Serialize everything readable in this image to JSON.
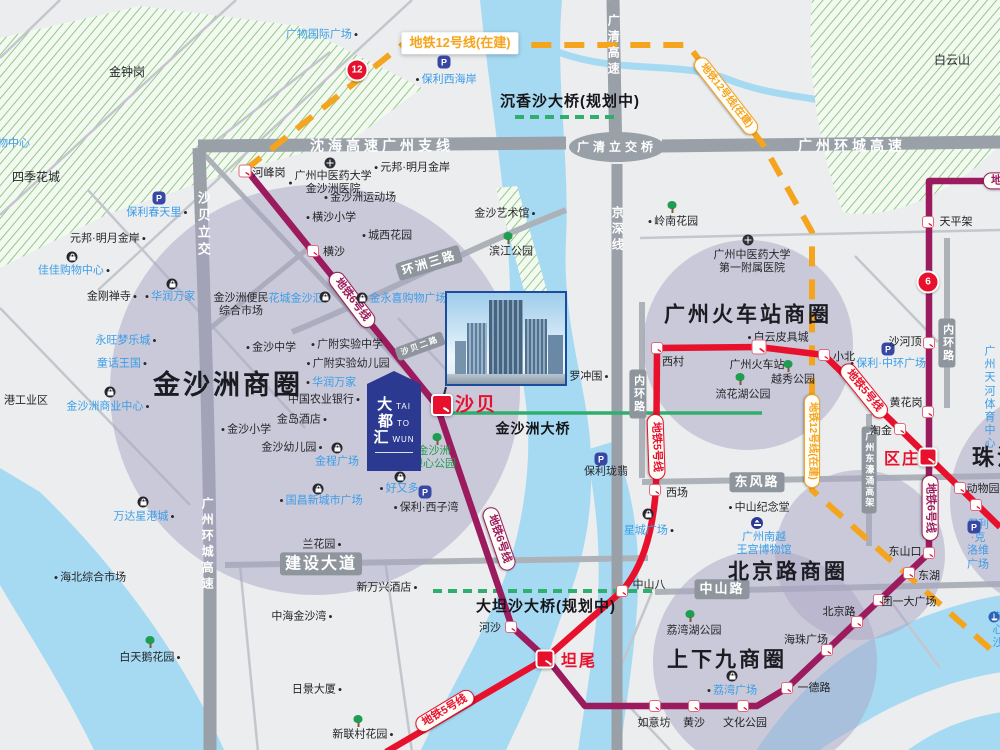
{
  "colors": {
    "line5": "#e8112d",
    "line6": "#9b1b5e",
    "line12": "#f5a41d",
    "water": "#a6daf2",
    "land": "#ebedee",
    "roadMajor": "#9aa0a8",
    "roadMed": "#adb2b9",
    "roadMinor": "#c3c7cd",
    "roadBox": "#8f959d",
    "circleFill": "rgba(170,165,196,0.5)",
    "green": "#2fae6e",
    "hatchLine": "#8fcb86",
    "hatchBg": "#f3f9f1",
    "blueText": "#3b9de8",
    "greenText": "#1f9e4b",
    "redText": "#e60012",
    "polyBlue": "#3847a3",
    "logoBlue": "#2b3990"
  },
  "icons": {
    "dot": "●",
    "p": "P"
  },
  "logo": {
    "rows": [
      {
        "cn": "大",
        "en": "TAI"
      },
      {
        "cn": "都",
        "en": "TO"
      },
      {
        "cn": "汇",
        "en": "WUN"
      }
    ]
  },
  "map": {
    "features": [
      {
        "t": "金钟岗",
        "x": 127,
        "y": 72,
        "k": "k",
        "s": 12
      },
      {
        "t": "四季花城",
        "x": 36,
        "y": 177,
        "k": "k",
        "s": 12
      },
      {
        "t": "购物中心",
        "x": 8,
        "y": 144,
        "k": "b"
      },
      {
        "t": "元邦·明月金岸",
        "x": 108,
        "y": 239,
        "k": "k",
        "dot": "r"
      },
      {
        "t": "佳佳购物中心",
        "x": 74,
        "y": 271,
        "k": "b",
        "dot": "r"
      },
      {
        "t": "金刚禅寺",
        "x": 112,
        "y": 297,
        "k": "k",
        "dot": "r"
      },
      {
        "t": "华润万家",
        "x": 170,
        "y": 297,
        "k": "b",
        "dot": "l"
      },
      {
        "t": "永旺梦乐城",
        "x": 126,
        "y": 341,
        "k": "b",
        "dot": "r"
      },
      {
        "t": "童话王国",
        "x": 122,
        "y": 364,
        "k": "b",
        "dot": "r"
      },
      {
        "t": "金沙洲商业中心",
        "x": 108,
        "y": 407,
        "k": "b",
        "dot": "r"
      },
      {
        "t": "港工业区",
        "x": 26,
        "y": 401,
        "k": "k"
      },
      {
        "t": "万达星港城",
        "x": 144,
        "y": 517,
        "k": "b",
        "dot": "r"
      },
      {
        "t": "海北综合市场",
        "x": 90,
        "y": 578,
        "k": "k",
        "dot": "l"
      },
      {
        "t": "白天鹅花园",
        "x": 150,
        "y": 658,
        "k": "k",
        "dot": "r"
      },
      {
        "t": "保利春天里",
        "x": 157,
        "y": 213,
        "k": "b",
        "dot": "r"
      },
      {
        "t": "元邦·明月金岸",
        "x": 412,
        "y": 168,
        "k": "k",
        "dot": "l"
      },
      {
        "t": "保利西海岸",
        "x": 446,
        "y": 80,
        "k": "b",
        "dot": "l"
      },
      {
        "t": "广物国际广场",
        "x": 322,
        "y": 35,
        "k": "b",
        "dot": "r"
      },
      {
        "t": "沙贝二路",
        "x": 420,
        "y": 346,
        "k": "roadbox",
        "s": 8,
        "rot": -20
      },
      {
        "t": "环洲三路",
        "x": 429,
        "y": 263,
        "k": "roadbox",
        "s": 12,
        "rot": -17
      },
      {
        "t": "金沙洲便民\n综合市场",
        "x": 241,
        "y": 305,
        "k": "k"
      },
      {
        "t": "花城金沙汇",
        "x": 296,
        "y": 299,
        "k": "b"
      },
      {
        "t": "金永喜购物广场",
        "x": 408,
        "y": 299,
        "k": "b"
      },
      {
        "t": "横沙小学",
        "x": 331,
        "y": 218,
        "k": "k",
        "dot": "l"
      },
      {
        "t": "城西花园",
        "x": 387,
        "y": 236,
        "k": "k",
        "dot": "l"
      },
      {
        "t": "金沙洲运动场",
        "x": 360,
        "y": 198,
        "k": "k",
        "dot": "l"
      },
      {
        "t": "广州中医药大学\n金沙洲医院",
        "x": 330,
        "y": 183,
        "k": "k",
        "dot": "l"
      },
      {
        "t": "金沙中学",
        "x": 271,
        "y": 348,
        "k": "k",
        "dot": "l"
      },
      {
        "t": "广附实验中学",
        "x": 347,
        "y": 345,
        "k": "k",
        "dot": "l"
      },
      {
        "t": "广附实验幼儿园",
        "x": 348,
        "y": 364,
        "k": "k",
        "dot": "l"
      },
      {
        "t": "华润万家",
        "x": 331,
        "y": 383,
        "k": "b",
        "dot": "l"
      },
      {
        "t": "中国农业银行",
        "x": 324,
        "y": 400,
        "k": "k",
        "dot": "r"
      },
      {
        "t": "金岛酒店",
        "x": 302,
        "y": 420,
        "k": "k",
        "dot": "r"
      },
      {
        "t": "金沙小学",
        "x": 246,
        "y": 430,
        "k": "k",
        "dot": "l"
      },
      {
        "t": "金沙幼儿园",
        "x": 292,
        "y": 448,
        "k": "k",
        "dot": "r"
      },
      {
        "t": "金程广场",
        "x": 337,
        "y": 462,
        "k": "b"
      },
      {
        "t": "国昌新城市广场",
        "x": 321,
        "y": 501,
        "k": "b",
        "dot": "l"
      },
      {
        "t": "好又多",
        "x": 399,
        "y": 489,
        "k": "b",
        "dot": "l"
      },
      {
        "t": "保利·西子湾",
        "x": 426,
        "y": 508,
        "k": "k",
        "dot": "l"
      },
      {
        "t": "兰花园",
        "x": 322,
        "y": 545,
        "k": "k",
        "dot": "r"
      },
      {
        "t": "建设大道",
        "x": 321,
        "y": 564,
        "k": "roadbox",
        "s": 16
      },
      {
        "t": "新万兴酒店",
        "x": 387,
        "y": 588,
        "k": "k",
        "dot": "r"
      },
      {
        "t": "中海金沙湾",
        "x": 302,
        "y": 617,
        "k": "k",
        "dot": "r"
      },
      {
        "t": "日景大厦",
        "x": 317,
        "y": 690,
        "k": "k",
        "dot": "r"
      },
      {
        "t": "新联村花园",
        "x": 363,
        "y": 735,
        "k": "k",
        "dot": "r"
      },
      {
        "t": "金沙洲商圈",
        "x": 228,
        "y": 385,
        "k": "big",
        "s": 27
      },
      {
        "t": "金沙洲\n绿心公园",
        "x": 434,
        "y": 458,
        "k": "g"
      },
      {
        "t": "沙贝立交",
        "x": 203,
        "y": 225,
        "k": "roadtextv",
        "s": 13
      },
      {
        "t": "广州环城高速",
        "x": 207,
        "y": 545,
        "k": "roadtextv",
        "s": 12
      },
      {
        "t": "沈海高速广州支线",
        "x": 382,
        "y": 146,
        "k": "roadtext",
        "s": 14
      },
      {
        "t": "广清高速",
        "x": 613,
        "y": 46,
        "k": "roadtextv",
        "s": 12
      },
      {
        "t": "广清立交桥",
        "x": 617,
        "y": 147,
        "k": "roadtext",
        "s": 12
      },
      {
        "t": "广州环城高速",
        "x": 852,
        "y": 146,
        "k": "roadtext",
        "s": 14
      },
      {
        "t": "京深线",
        "x": 617,
        "y": 230,
        "k": "roadtextv",
        "s": 12
      },
      {
        "t": "沉香沙大桥(规划中)",
        "x": 570,
        "y": 102,
        "k": "bold",
        "s": 15
      },
      {
        "t": "大坦沙大桥(规划中)",
        "x": 546,
        "y": 607,
        "k": "bold",
        "s": 15
      },
      {
        "t": "金沙洲大桥",
        "x": 533,
        "y": 429,
        "k": "bold",
        "s": 14
      },
      {
        "t": "白云山",
        "x": 952,
        "y": 60,
        "k": "k",
        "s": 12
      },
      {
        "t": "岭南花园",
        "x": 673,
        "y": 222,
        "k": "k",
        "dot": "l"
      },
      {
        "t": "金沙艺术馆",
        "x": 505,
        "y": 214,
        "k": "k",
        "dot": "r"
      },
      {
        "t": "滨江公园",
        "x": 511,
        "y": 252,
        "k": "k"
      },
      {
        "t": "罗冲围",
        "x": 589,
        "y": 377,
        "k": "k",
        "dot": "r"
      },
      {
        "t": "保利珑翡",
        "x": 606,
        "y": 472,
        "k": "k"
      },
      {
        "t": "内环路",
        "x": 638,
        "y": 394,
        "k": "roadboxv",
        "s": 11
      },
      {
        "t": "内环路",
        "x": 947,
        "y": 343,
        "k": "roadboxv",
        "s": 11
      },
      {
        "t": "东风路",
        "x": 757,
        "y": 482,
        "k": "roadbox",
        "s": 13
      },
      {
        "t": "中山路",
        "x": 722,
        "y": 589,
        "k": "roadbox",
        "s": 13
      },
      {
        "t": "广州东濠涌高架",
        "x": 869,
        "y": 470,
        "k": "roadboxv",
        "s": 9
      },
      {
        "t": "广州中医药大学\n第一附属医院",
        "x": 752,
        "y": 262,
        "k": "k"
      },
      {
        "t": "广州火车站商圈",
        "x": 748,
        "y": 315,
        "k": "big",
        "s": 21
      },
      {
        "t": "白云皮具城",
        "x": 778,
        "y": 338,
        "k": "k",
        "dot": "l"
      },
      {
        "t": "越秀公园",
        "x": 793,
        "y": 380,
        "k": "k"
      },
      {
        "t": "流花湖公园",
        "x": 743,
        "y": 395,
        "k": "k"
      },
      {
        "t": "保利·中环广场",
        "x": 888,
        "y": 364,
        "k": "b",
        "dot": "l"
      },
      {
        "t": "广州天河\n体育中心",
        "x": 990,
        "y": 398,
        "k": "b"
      },
      {
        "t": "中山纪念堂",
        "x": 759,
        "y": 508,
        "k": "k",
        "dot": "l"
      },
      {
        "t": "广州南越\n王宫博物馆",
        "x": 764,
        "y": 544,
        "k": "b"
      },
      {
        "t": "北京路商圈",
        "x": 788,
        "y": 572,
        "k": "big",
        "s": 21
      },
      {
        "t": "上下九商圈",
        "x": 727,
        "y": 660,
        "k": "big",
        "s": 21
      },
      {
        "t": "荔湾湖公园",
        "x": 694,
        "y": 631,
        "k": "k"
      },
      {
        "t": "荔湾广场",
        "x": 732,
        "y": 691,
        "k": "b",
        "dot": "l"
      },
      {
        "t": "珠江新城",
        "x": 1022,
        "y": 458,
        "k": "big",
        "s": 22
      },
      {
        "t": "保利·克洛维广场",
        "x": 978,
        "y": 545,
        "k": "b"
      },
      {
        "t": "海心沙",
        "x": 998,
        "y": 631,
        "k": "b"
      },
      {
        "t": "星城广场",
        "x": 649,
        "y": 531,
        "k": "b",
        "dot": "r"
      },
      {
        "t": "地铁12号线(在建)",
        "x": 460,
        "y": 43,
        "k": "lc12box",
        "s": 13
      },
      {
        "t": "地铁12号线(在建)",
        "x": 726,
        "y": 96,
        "k": "lc12",
        "rot": 52,
        "s": 10
      },
      {
        "t": "地铁12号线(在建)",
        "x": 812,
        "y": 441,
        "k": "lc12",
        "rot": 90,
        "s": 10
      },
      {
        "t": "地铁6号线",
        "x": 352,
        "y": 300,
        "k": "lc6",
        "rot": 53
      },
      {
        "t": "地铁6号线",
        "x": 499,
        "y": 539,
        "k": "lc6",
        "rot": 71
      },
      {
        "t": "地铁6号线",
        "x": 930,
        "y": 508,
        "k": "lc6",
        "rot": 90
      },
      {
        "t": "地铁6号线",
        "x": 1016,
        "y": 181,
        "k": "lc6"
      },
      {
        "t": "地铁5号线",
        "x": 656,
        "y": 447,
        "k": "lc5",
        "rot": 88
      },
      {
        "t": "地铁5号线",
        "x": 864,
        "y": 391,
        "k": "lc5",
        "rot": 51
      },
      {
        "t": "地铁5号线",
        "x": 445,
        "y": 711,
        "k": "lc5",
        "rot": -31
      }
    ],
    "stations": [
      {
        "n": "河峰岗",
        "x": 245,
        "y": 171,
        "s": 13,
        "lx": 269,
        "ly": 172
      },
      {
        "n": "横沙",
        "x": 313,
        "y": 251,
        "s": 12,
        "lx": 334,
        "ly": 251
      },
      {
        "n": "沙贝",
        "x": 442,
        "y": 405,
        "s": 22,
        "red": 1,
        "lx": 476,
        "ly": 403,
        "lr": 1,
        "ls": 19
      },
      {
        "n": "河沙",
        "x": 511,
        "y": 627,
        "s": 12,
        "lx": 490,
        "ly": 627
      },
      {
        "n": "坦尾",
        "x": 545,
        "y": 659,
        "s": 19,
        "red": 1,
        "lx": 579,
        "ly": 659,
        "lr": 1,
        "ls": 16
      },
      {
        "n": "如意坊",
        "x": 655,
        "y": 706,
        "s": 12,
        "lx": 654,
        "ly": 722
      },
      {
        "n": "黄沙",
        "x": 694,
        "y": 706,
        "s": 12,
        "lx": 694,
        "ly": 722
      },
      {
        "n": "文化公园",
        "x": 743,
        "y": 706,
        "s": 12,
        "lx": 745,
        "ly": 722
      },
      {
        "n": "一德路",
        "x": 787,
        "y": 688,
        "s": 12,
        "lx": 814,
        "ly": 687
      },
      {
        "n": "海珠广场",
        "x": 827,
        "y": 650,
        "s": 12,
        "lx": 806,
        "ly": 639
      },
      {
        "n": "北京路",
        "x": 857,
        "y": 622,
        "s": 12,
        "lx": 839,
        "ly": 611
      },
      {
        "n": "团一大广场",
        "x": 879,
        "y": 600,
        "s": 12,
        "lx": 909,
        "ly": 601
      },
      {
        "n": "东湖",
        "x": 909,
        "y": 573,
        "s": 12,
        "lx": 929,
        "ly": 575
      },
      {
        "n": "东山口",
        "x": 929,
        "y": 553,
        "s": 12,
        "lx": 905,
        "ly": 551
      },
      {
        "n": "区庄",
        "x": 928,
        "y": 457,
        "s": 19,
        "red": 1,
        "lx": 902,
        "ly": 457,
        "lr": 1,
        "ls": 16
      },
      {
        "n": "黄花岗",
        "x": 928,
        "y": 412,
        "s": 12,
        "lx": 906,
        "ly": 402
      },
      {
        "n": "沙河顶",
        "x": 929,
        "y": 343,
        "s": 12,
        "lx": 905,
        "ly": 341
      },
      {
        "n": "天平架",
        "x": 928,
        "y": 222,
        "s": 12,
        "lx": 956,
        "ly": 221
      },
      {
        "n": "西村",
        "x": 657,
        "y": 348,
        "s": 12,
        "lx": 673,
        "ly": 361
      },
      {
        "n": "广州火车站",
        "x": 759,
        "y": 347,
        "s": 15,
        "lx": 757,
        "ly": 364
      },
      {
        "n": "西场",
        "x": 655,
        "y": 490,
        "s": 12,
        "lx": 677,
        "ly": 492
      },
      {
        "n": "中山八",
        "x": 622,
        "y": 591,
        "s": 12,
        "lx": 649,
        "ly": 584
      },
      {
        "n": "小北",
        "x": 824,
        "y": 355,
        "s": 12,
        "lx": 844,
        "ly": 356
      },
      {
        "n": "淘金",
        "x": 900,
        "y": 429,
        "s": 12,
        "lx": 881,
        "ly": 430
      },
      {
        "n": "动物园",
        "x": 960,
        "y": 488,
        "s": 12,
        "lx": 983,
        "ly": 488
      },
      {
        "n": "",
        "x": 976,
        "y": 505,
        "s": 12,
        "lx": 0,
        "ly": 0
      }
    ],
    "badges": [
      {
        "t": "12",
        "x": 357,
        "y": 70
      },
      {
        "t": "6",
        "x": 928,
        "y": 282
      }
    ],
    "pins": [
      {
        "k": "tree",
        "x": 672,
        "y": 207
      },
      {
        "k": "tree",
        "x": 788,
        "y": 366
      },
      {
        "k": "tree",
        "x": 740,
        "y": 379
      },
      {
        "k": "tree",
        "x": 508,
        "y": 238
      },
      {
        "k": "tree",
        "x": 690,
        "y": 616
      },
      {
        "k": "tree",
        "x": 150,
        "y": 642
      },
      {
        "k": "tree",
        "x": 358,
        "y": 721
      },
      {
        "k": "tree",
        "x": 437,
        "y": 439
      },
      {
        "k": "mall",
        "x": 72,
        "y": 257
      },
      {
        "k": "mall",
        "x": 172,
        "y": 284
      },
      {
        "k": "mall",
        "x": 110,
        "y": 392
      },
      {
        "k": "mall",
        "x": 143,
        "y": 502
      },
      {
        "k": "mall",
        "x": 325,
        "y": 297
      },
      {
        "k": "mall",
        "x": 362,
        "y": 298
      },
      {
        "k": "mall",
        "x": 337,
        "y": 448
      },
      {
        "k": "mall",
        "x": 318,
        "y": 489
      },
      {
        "k": "mall",
        "x": 648,
        "y": 514
      },
      {
        "k": "mall",
        "x": 732,
        "y": 676
      },
      {
        "k": "mall",
        "x": 400,
        "y": 477
      },
      {
        "k": "hosp",
        "x": 330,
        "y": 163
      },
      {
        "k": "hosp",
        "x": 748,
        "y": 240
      },
      {
        "k": "poly",
        "x": 444,
        "y": 62
      },
      {
        "k": "poly",
        "x": 159,
        "y": 198
      },
      {
        "k": "poly",
        "x": 425,
        "y": 492
      },
      {
        "k": "poly",
        "x": 601,
        "y": 459
      },
      {
        "k": "poly",
        "x": 888,
        "y": 349
      },
      {
        "k": "poly",
        "x": 974,
        "y": 527
      },
      {
        "k": "mus",
        "x": 757,
        "y": 523
      },
      {
        "k": "anchor",
        "x": 994,
        "y": 617
      }
    ]
  }
}
